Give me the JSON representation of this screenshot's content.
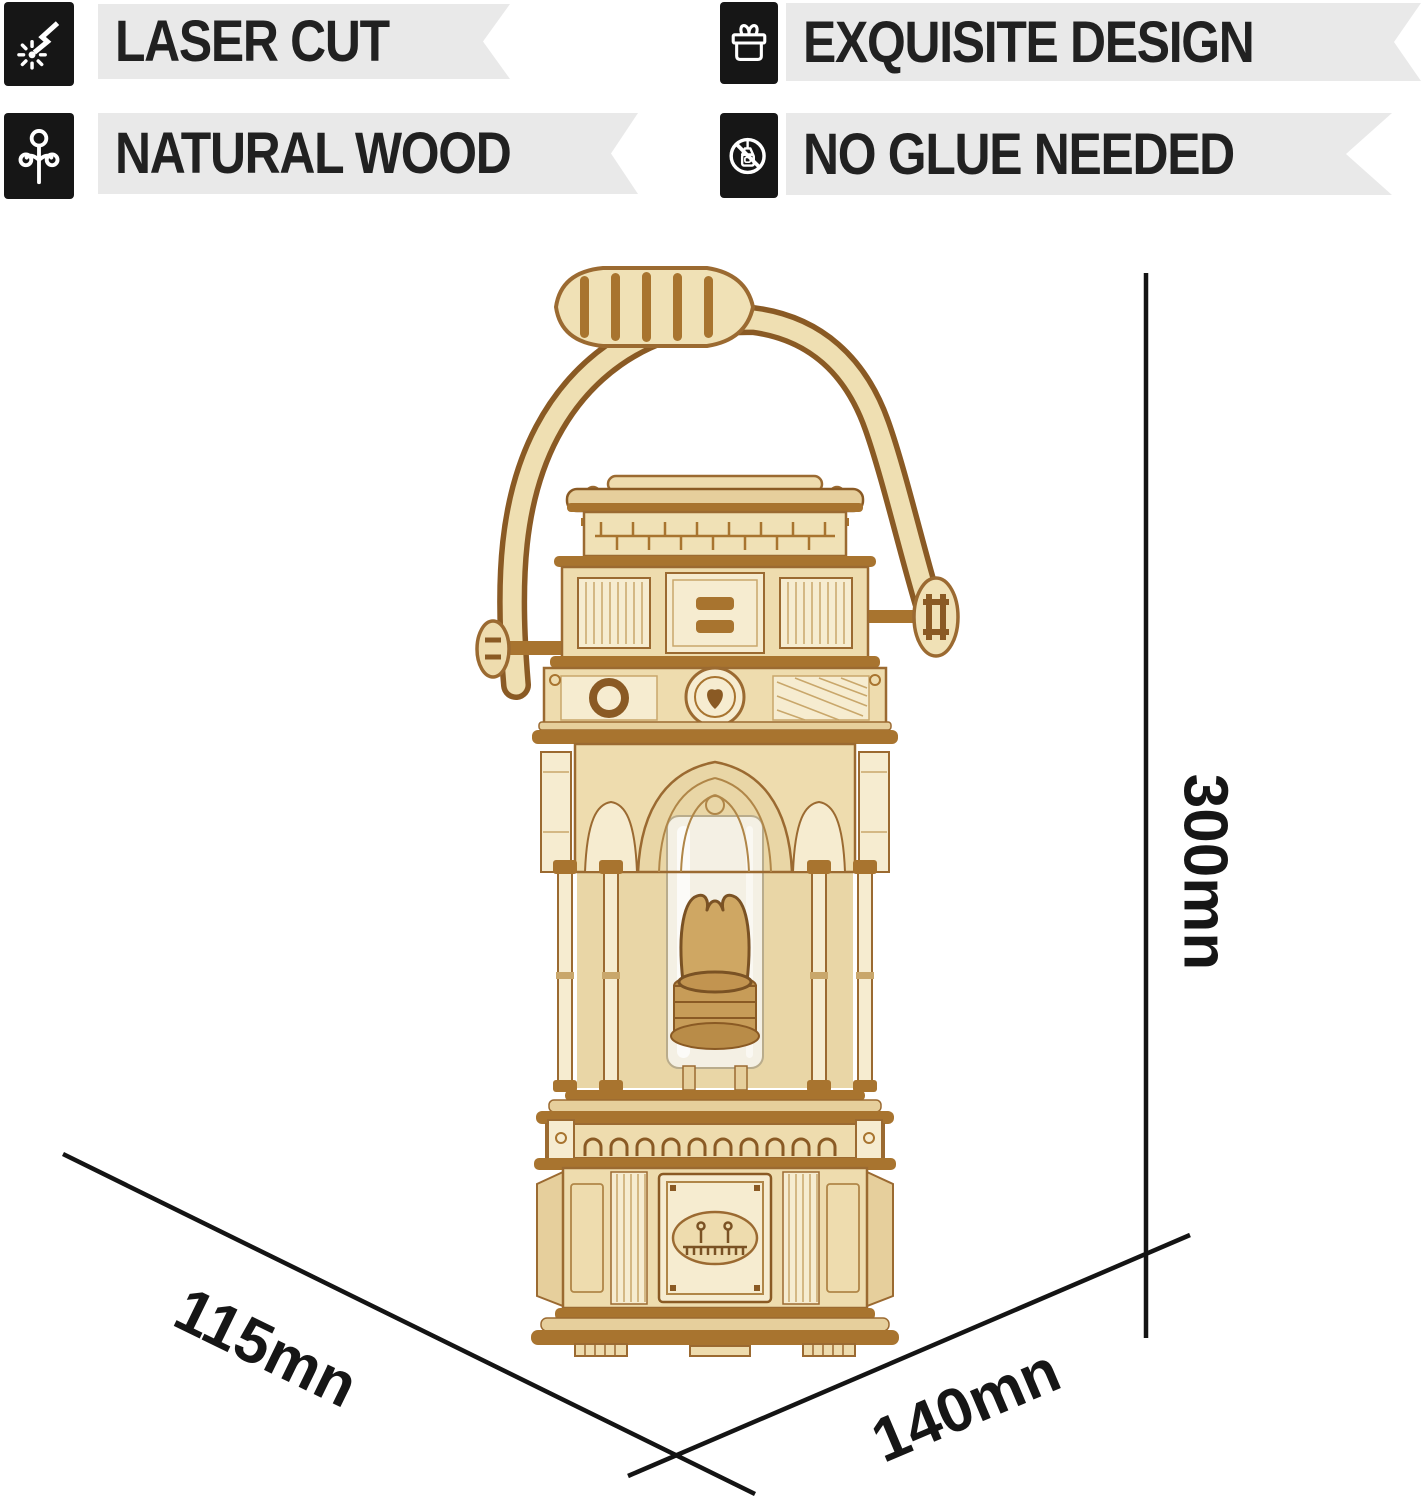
{
  "features": {
    "items": [
      {
        "icon": "laser-cut-icon",
        "label": "LASER CUT"
      },
      {
        "icon": "natural-wood-icon",
        "label": "NATURAL WOOD"
      },
      {
        "icon": "gift-box-icon",
        "label": "EXQUISITE DESIGN"
      },
      {
        "icon": "no-glue-icon",
        "label": "NO GLUE NEEDED"
      }
    ]
  },
  "dimensions": {
    "height_label": "300mn",
    "depth_label": "115mn",
    "width_label": "140mn"
  },
  "illustration": {
    "subject": "victorian-lantern-3d-wooden-puzzle"
  },
  "colors": {
    "badge_background": "#161616",
    "ribbon_background": "#e9e9e9",
    "text": "#1f1f1f",
    "dimension_line": "#141414",
    "wood_light": "#f3e7c6",
    "wood_mid": "#e6cf9c",
    "wood_dark": "#9b6a31",
    "background": "#ffffff"
  }
}
